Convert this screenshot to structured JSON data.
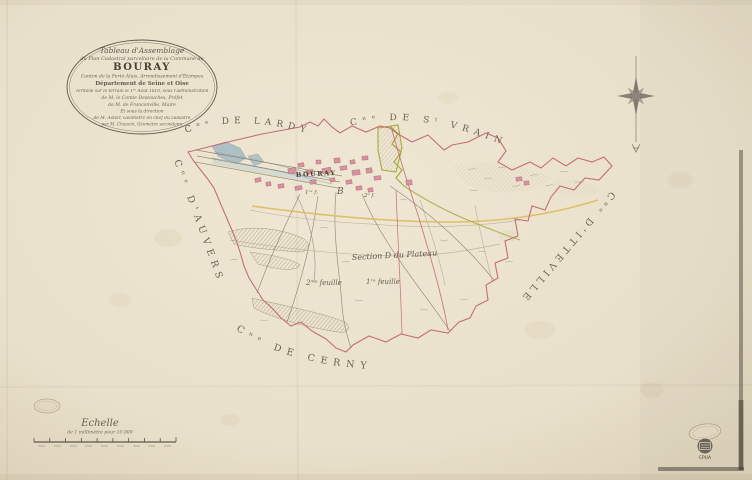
{
  "document": {
    "kind": "Scanned historical cadastral map — tableau d'assemblage",
    "commune": "Bouray"
  },
  "cartouche": {
    "line1": "Tableau d'Assemblage",
    "line2": "du Plan Cadastral parcellaire de la Commune de",
    "title": "BOURAY",
    "line4": "Canton de la Ferté-Alais, Arrondissement d'Étampes",
    "line5": "Département de Seine et Oise",
    "line6": "Terminé sur le terrain le 1ᵉʳ Août 1810, sous l'administration",
    "line7": "de M. le Comte Destouches, Préfet",
    "line8": "de M. de Franconville, Maire",
    "line9": "Et sous la direction",
    "line10": "de M. Astier, Géomètre en chef du cadastre",
    "line11": "par M. Chauvin, Géomètre secondaire"
  },
  "neighbors": {
    "lardy": "Cⁿᵉ DE LARDY",
    "st_vrain": "Cⁿᵉ DE Sᵗ VRAIN",
    "auvers": "Cⁿᵉ D'AUVERS",
    "itteville": "Cⁿᵉ D'ITTEVILLE",
    "cerny": "Cⁿᵉ DE CERNY"
  },
  "annotations": {
    "village": "BOURAY",
    "section_note": "Section D du Plateau",
    "sheet_note_left": "2ᵐᵉ feuille",
    "sheet_note_right": "1ʳᵉ feuille",
    "village_sheet_left": "1ʳᵉ f.",
    "village_section_letter": "B",
    "village_sheet_right": "2ᵉ f."
  },
  "scale": {
    "label": "Echelle",
    "sublabel": "de 1 millimètre pour 10.000"
  },
  "stamps": {
    "archive_code": "CPUA"
  },
  "symbols": {
    "compass": "compass-rose-eight-point-star-with-south-needle",
    "embossed_stamp_left": "blind-embossed-oval-stamp",
    "embossed_stamp_right": "blind-embossed-oval-stamp",
    "archive_stamp": "round-ink-stamp"
  },
  "colors": {
    "paper": "#e9e0cb",
    "boundary_pink": "#c25f6e",
    "road_yellow": "#d9bd62",
    "water_blue": "#a9bcc4",
    "village_pink": "#d593a0",
    "section_green": "#a9a93e",
    "ink": "#4a4036"
  }
}
